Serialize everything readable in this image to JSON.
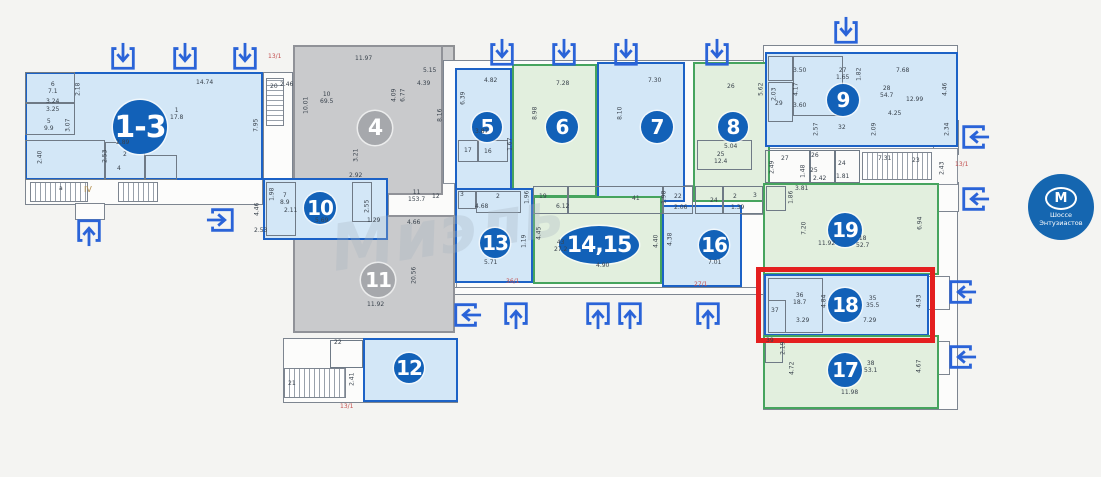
{
  "colors": {
    "blue_border": "#1c62c6",
    "blue_fill": "#d3e7f7",
    "green_border": "#46a45e",
    "green_fill": "#e2efde",
    "gray_fill": "#c9cacc",
    "badge_blue": "#1261b8",
    "badge_gray": "#a6a8ac",
    "arrow": "#2a63d8",
    "highlight_red": "#e41f1f",
    "annotation_red": "#c34f4f",
    "metro_blue": "#1566b0"
  },
  "watermark": {
    "text": "Миэль"
  },
  "metro": {
    "symbol": "М",
    "name": "Шоссе\nЭнтузиастов"
  },
  "highlight": {
    "x": 756,
    "y": 267,
    "w": 179,
    "h": 76
  },
  "structures": [
    {
      "x": 25,
      "y": 72,
      "w": 238,
      "h": 133,
      "cls": "st-outline"
    },
    {
      "x": 75,
      "y": 203,
      "w": 30,
      "h": 17,
      "cls": "st-outline"
    },
    {
      "x": 263,
      "y": 72,
      "w": 30,
      "h": 108,
      "cls": "st-outline"
    },
    {
      "x": 293,
      "y": 45,
      "w": 162,
      "h": 288,
      "cls": "st-gray"
    },
    {
      "x": 443,
      "y": 60,
      "w": 327,
      "h": 235,
      "cls": "st-outline"
    },
    {
      "x": 763,
      "y": 45,
      "w": 195,
      "h": 365,
      "cls": "st-outline"
    },
    {
      "x": 283,
      "y": 338,
      "w": 175,
      "h": 65,
      "cls": "st-outline"
    },
    {
      "x": 933,
      "y": 120,
      "w": 26,
      "h": 35,
      "cls": "st-outline"
    },
    {
      "x": 933,
      "y": 182,
      "w": 26,
      "h": 30,
      "cls": "st-outline"
    },
    {
      "x": 928,
      "y": 276,
      "w": 22,
      "h": 34,
      "cls": "st-outline"
    },
    {
      "x": 928,
      "y": 341,
      "w": 22,
      "h": 34,
      "cls": "st-outline"
    },
    {
      "x": 443,
      "y": 185,
      "w": 320,
      "h": 30,
      "cls": "st-corridor"
    },
    {
      "x": 388,
      "y": 183,
      "w": 67,
      "h": 42,
      "cls": "st-corridor"
    },
    {
      "x": 443,
      "y": 215,
      "w": 14,
      "h": 80,
      "cls": "st-corridor"
    },
    {
      "x": 763,
      "y": 148,
      "w": 195,
      "h": 37,
      "cls": "st-corridor"
    }
  ],
  "stairs": [
    {
      "x": 30,
      "y": 182,
      "w": 58,
      "h": 20
    },
    {
      "x": 118,
      "y": 182,
      "w": 40,
      "h": 20
    },
    {
      "x": 266,
      "y": 78,
      "w": 18,
      "h": 48,
      "dir": "v"
    },
    {
      "x": 862,
      "y": 152,
      "w": 70,
      "h": 28
    },
    {
      "x": 284,
      "y": 368,
      "w": 62,
      "h": 30
    }
  ],
  "units": [
    {
      "label": "1-3",
      "type": "blue",
      "x": 25,
      "y": 72,
      "w": 238,
      "h": 108,
      "badge": {
        "cx": 140,
        "cy": 127,
        "r": 27,
        "fs": 30
      }
    },
    {
      "label": "4",
      "type": "gray",
      "x": 293,
      "y": 45,
      "w": 150,
      "h": 150,
      "badge": {
        "cx": 375,
        "cy": 128,
        "r": 17,
        "fs": 22
      }
    },
    {
      "label": "11",
      "type": "gray",
      "x": 293,
      "y": 215,
      "w": 162,
      "h": 118,
      "badge": {
        "cx": 378,
        "cy": 280,
        "r": 17,
        "fs": 20
      }
    },
    {
      "label": "5",
      "type": "blue",
      "x": 455,
      "y": 68,
      "w": 57,
      "h": 127,
      "badge": {
        "cx": 487,
        "cy": 127,
        "r": 15,
        "fs": 20
      }
    },
    {
      "label": "6",
      "type": "green",
      "x": 512,
      "y": 64,
      "w": 85,
      "h": 133,
      "badge": {
        "cx": 562,
        "cy": 127,
        "r": 16,
        "fs": 20
      }
    },
    {
      "label": "7",
      "type": "blue",
      "x": 597,
      "y": 62,
      "w": 88,
      "h": 140,
      "badge": {
        "cx": 657,
        "cy": 127,
        "r": 16,
        "fs": 20
      }
    },
    {
      "label": "8",
      "type": "green",
      "x": 693,
      "y": 62,
      "w": 77,
      "h": 140,
      "badge": {
        "cx": 733,
        "cy": 127,
        "r": 15,
        "fs": 20
      }
    },
    {
      "label": "9",
      "type": "blue",
      "x": 765,
      "y": 52,
      "w": 193,
      "h": 95,
      "badge": {
        "cx": 843,
        "cy": 100,
        "r": 16,
        "fs": 20
      }
    },
    {
      "label": "10",
      "type": "blue",
      "x": 263,
      "y": 178,
      "w": 125,
      "h": 62,
      "badge": {
        "cx": 320,
        "cy": 208,
        "r": 16,
        "fs": 20
      }
    },
    {
      "label": "12",
      "type": "blue",
      "x": 363,
      "y": 338,
      "w": 95,
      "h": 64,
      "badge": {
        "cx": 409,
        "cy": 368,
        "r": 15,
        "fs": 20
      }
    },
    {
      "label": "13",
      "type": "blue",
      "x": 455,
      "y": 188,
      "w": 78,
      "h": 95,
      "badge": {
        "cx": 495,
        "cy": 243,
        "r": 15,
        "fs": 20
      }
    },
    {
      "label": "14,15",
      "type": "green",
      "x": 533,
      "y": 196,
      "w": 129,
      "h": 88,
      "badge": {
        "cx": 599,
        "cy": 245,
        "rx": 40,
        "ry": 19,
        "fs": 22
      }
    },
    {
      "label": "16",
      "type": "blue",
      "x": 662,
      "y": 205,
      "w": 80,
      "h": 82,
      "badge": {
        "cx": 714,
        "cy": 245,
        "r": 15,
        "fs": 20
      }
    },
    {
      "label": "19",
      "type": "green",
      "x": 763,
      "y": 183,
      "w": 176,
      "h": 92,
      "badge": {
        "cx": 845,
        "cy": 230,
        "r": 17,
        "fs": 20
      }
    },
    {
      "label": "18",
      "type": "blue",
      "x": 764,
      "y": 274,
      "w": 165,
      "h": 62,
      "badge": {
        "cx": 845,
        "cy": 305,
        "r": 17,
        "fs": 20
      },
      "highlighted": true
    },
    {
      "label": "17",
      "type": "green",
      "x": 763,
      "y": 335,
      "w": 176,
      "h": 74,
      "badge": {
        "cx": 845,
        "cy": 370,
        "r": 17,
        "fs": 20
      }
    }
  ],
  "partitions": [
    {
      "x": 25,
      "y": 72,
      "w": 50,
      "h": 31
    },
    {
      "x": 25,
      "y": 103,
      "w": 50,
      "h": 32
    },
    {
      "x": 25,
      "y": 140,
      "w": 80,
      "h": 40
    },
    {
      "x": 105,
      "y": 142,
      "w": 40,
      "h": 38
    },
    {
      "x": 145,
      "y": 155,
      "w": 32,
      "h": 25
    },
    {
      "x": 458,
      "y": 140,
      "w": 20,
      "h": 22
    },
    {
      "x": 478,
      "y": 140,
      "w": 30,
      "h": 22
    },
    {
      "x": 266,
      "y": 182,
      "w": 30,
      "h": 54
    },
    {
      "x": 352,
      "y": 182,
      "w": 20,
      "h": 40
    },
    {
      "x": 458,
      "y": 191,
      "w": 18,
      "h": 18
    },
    {
      "x": 476,
      "y": 191,
      "w": 45,
      "h": 22
    },
    {
      "x": 533,
      "y": 186,
      "w": 35,
      "h": 28
    },
    {
      "x": 568,
      "y": 186,
      "w": 95,
      "h": 28
    },
    {
      "x": 663,
      "y": 186,
      "w": 30,
      "h": 28
    },
    {
      "x": 695,
      "y": 186,
      "w": 28,
      "h": 28
    },
    {
      "x": 723,
      "y": 186,
      "w": 40,
      "h": 28
    },
    {
      "x": 697,
      "y": 140,
      "w": 55,
      "h": 30
    },
    {
      "x": 768,
      "y": 56,
      "w": 25,
      "h": 25
    },
    {
      "x": 768,
      "y": 82,
      "w": 25,
      "h": 40
    },
    {
      "x": 793,
      "y": 56,
      "w": 50,
      "h": 60
    },
    {
      "x": 765,
      "y": 150,
      "w": 45,
      "h": 33
    },
    {
      "x": 810,
      "y": 150,
      "w": 25,
      "h": 33
    },
    {
      "x": 835,
      "y": 150,
      "w": 25,
      "h": 33
    },
    {
      "x": 766,
      "y": 186,
      "w": 20,
      "h": 25
    },
    {
      "x": 768,
      "y": 278,
      "w": 55,
      "h": 55
    },
    {
      "x": 768,
      "y": 300,
      "w": 18,
      "h": 33
    },
    {
      "x": 765,
      "y": 338,
      "w": 18,
      "h": 25
    },
    {
      "x": 330,
      "y": 340,
      "w": 33,
      "h": 28
    }
  ],
  "corridor_lines": [
    {
      "x": 455,
      "y": 287,
      "w": 302,
      "h": 8
    }
  ],
  "arrows": [
    {
      "d": "down",
      "x": 108,
      "y": 42
    },
    {
      "d": "down",
      "x": 170,
      "y": 42
    },
    {
      "d": "down",
      "x": 230,
      "y": 42
    },
    {
      "d": "down",
      "x": 487,
      "y": 38
    },
    {
      "d": "down",
      "x": 549,
      "y": 38
    },
    {
      "d": "down",
      "x": 611,
      "y": 38
    },
    {
      "d": "down",
      "x": 702,
      "y": 38
    },
    {
      "d": "down",
      "x": 831,
      "y": 16
    },
    {
      "d": "up",
      "x": 74,
      "y": 217
    },
    {
      "d": "right",
      "x": 206,
      "y": 205
    },
    {
      "d": "left",
      "x": 452,
      "y": 300
    },
    {
      "d": "up",
      "x": 501,
      "y": 300
    },
    {
      "d": "up",
      "x": 583,
      "y": 300
    },
    {
      "d": "up",
      "x": 615,
      "y": 300
    },
    {
      "d": "up",
      "x": 693,
      "y": 300
    },
    {
      "d": "left",
      "x": 960,
      "y": 122
    },
    {
      "d": "left",
      "x": 960,
      "y": 184
    },
    {
      "d": "left",
      "x": 947,
      "y": 277
    },
    {
      "d": "left",
      "x": 947,
      "y": 342
    }
  ],
  "labels": [
    {
      "t": "14.74",
      "x": 196,
      "y": 80
    },
    {
      "t": "6\n7.1",
      "x": 48,
      "y": 82
    },
    {
      "t": "2.18",
      "x": 72,
      "y": 86,
      "r": 1
    },
    {
      "t": "3.24",
      "x": 46,
      "y": 99
    },
    {
      "t": "3.25",
      "x": 46,
      "y": 107
    },
    {
      "t": "5\n9.9",
      "x": 44,
      "y": 119
    },
    {
      "t": "3.07",
      "x": 62,
      "y": 122,
      "r": 1
    },
    {
      "t": "1\n17.8",
      "x": 170,
      "y": 108
    },
    {
      "t": "7.95",
      "x": 250,
      "y": 122,
      "r": 1
    },
    {
      "t": "2.40",
      "x": 34,
      "y": 154,
      "r": 1
    },
    {
      "t": "2.89",
      "x": 116,
      "y": 140
    },
    {
      "t": "2.53",
      "x": 99,
      "y": 153,
      "r": 1
    },
    {
      "t": "2",
      "x": 123,
      "y": 152
    },
    {
      "t": "4",
      "x": 117,
      "y": 166
    },
    {
      "t": "a",
      "x": 59,
      "y": 186
    },
    {
      "t": "IV",
      "x": 84,
      "y": 187,
      "c": "tan"
    },
    {
      "t": "13/1",
      "x": 268,
      "y": 54,
      "c": "red"
    },
    {
      "t": "20",
      "x": 270,
      "y": 84
    },
    {
      "t": "2.46",
      "x": 280,
      "y": 82
    },
    {
      "t": "11.97",
      "x": 355,
      "y": 56
    },
    {
      "t": "10\n69.5",
      "x": 320,
      "y": 92
    },
    {
      "t": "10.01",
      "x": 298,
      "y": 102,
      "r": 1
    },
    {
      "t": "5.15",
      "x": 423,
      "y": 68
    },
    {
      "t": "4.39",
      "x": 417,
      "y": 81
    },
    {
      "t": "4.09",
      "x": 388,
      "y": 92,
      "r": 1
    },
    {
      "t": "6.77",
      "x": 397,
      "y": 92,
      "r": 1
    },
    {
      "t": "8.16",
      "x": 434,
      "y": 112,
      "r": 1
    },
    {
      "t": "3.21",
      "x": 350,
      "y": 152,
      "r": 1
    },
    {
      "t": "2.92",
      "x": 349,
      "y": 173
    },
    {
      "t": "20.56",
      "x": 406,
      "y": 272,
      "r": 1
    },
    {
      "t": "11.92",
      "x": 367,
      "y": 302
    },
    {
      "t": "22",
      "x": 334,
      "y": 340
    },
    {
      "t": "21",
      "x": 288,
      "y": 381
    },
    {
      "t": "2.41",
      "x": 346,
      "y": 376,
      "r": 1
    },
    {
      "t": "13/1",
      "x": 340,
      "y": 404,
      "c": "red"
    },
    {
      "t": "1.98",
      "x": 266,
      "y": 191,
      "r": 1
    },
    {
      "t": "7\n8.9",
      "x": 280,
      "y": 193
    },
    {
      "t": "2.11",
      "x": 284,
      "y": 208
    },
    {
      "t": "5.69",
      "x": 315,
      "y": 218
    },
    {
      "t": "2.55",
      "x": 361,
      "y": 203,
      "r": 1
    },
    {
      "t": "1.29",
      "x": 367,
      "y": 218
    },
    {
      "t": "4.46",
      "x": 251,
      "y": 206,
      "r": 1
    },
    {
      "t": "2.53",
      "x": 254,
      "y": 228
    },
    {
      "t": "11\n153.7",
      "x": 408,
      "y": 190
    },
    {
      "t": "12",
      "x": 432,
      "y": 194
    },
    {
      "t": "4.66",
      "x": 407,
      "y": 220
    },
    {
      "t": "6.39",
      "x": 457,
      "y": 95,
      "r": 1
    },
    {
      "t": "4.82",
      "x": 484,
      "y": 78
    },
    {
      "t": "3.87",
      "x": 475,
      "y": 129
    },
    {
      "t": "17",
      "x": 464,
      "y": 148
    },
    {
      "t": "16",
      "x": 484,
      "y": 149
    },
    {
      "t": "1.67",
      "x": 504,
      "y": 141,
      "r": 1
    },
    {
      "t": "7.28",
      "x": 556,
      "y": 81
    },
    {
      "t": "8.98",
      "x": 529,
      "y": 110,
      "r": 1
    },
    {
      "t": "7.30",
      "x": 648,
      "y": 78
    },
    {
      "t": "8.10",
      "x": 614,
      "y": 110,
      "r": 1
    },
    {
      "t": "26",
      "x": 727,
      "y": 84
    },
    {
      "t": "5.62",
      "x": 755,
      "y": 86,
      "r": 1
    },
    {
      "t": "5.04",
      "x": 724,
      "y": 144
    },
    {
      "t": "25\n12.4",
      "x": 714,
      "y": 152
    },
    {
      "t": "19",
      "x": 539,
      "y": 194
    },
    {
      "t": "41",
      "x": 632,
      "y": 196
    },
    {
      "t": "1.98",
      "x": 658,
      "y": 194,
      "r": 1
    },
    {
      "t": "22",
      "x": 674,
      "y": 194
    },
    {
      "t": "2.06",
      "x": 674,
      "y": 205
    },
    {
      "t": "24",
      "x": 710,
      "y": 198
    },
    {
      "t": "2",
      "x": 733,
      "y": 194
    },
    {
      "t": "1.39",
      "x": 731,
      "y": 205
    },
    {
      "t": "3",
      "x": 753,
      "y": 193
    },
    {
      "t": "3",
      "x": 460,
      "y": 192
    },
    {
      "t": "2",
      "x": 496,
      "y": 194
    },
    {
      "t": "4.68",
      "x": 475,
      "y": 204
    },
    {
      "t": "1.96",
      "x": 521,
      "y": 194,
      "r": 1
    },
    {
      "t": "1.19",
      "x": 518,
      "y": 238,
      "r": 1
    },
    {
      "t": "5.71",
      "x": 484,
      "y": 260
    },
    {
      "t": "6.12",
      "x": 556,
      "y": 204
    },
    {
      "t": "4.45",
      "x": 533,
      "y": 230,
      "r": 1
    },
    {
      "t": "43\n27.2",
      "x": 554,
      "y": 240
    },
    {
      "t": "4.40",
      "x": 650,
      "y": 238,
      "r": 1
    },
    {
      "t": "4.90",
      "x": 596,
      "y": 263
    },
    {
      "t": "4.38",
      "x": 664,
      "y": 236,
      "r": 1
    },
    {
      "t": "7.01",
      "x": 708,
      "y": 260
    },
    {
      "t": "3.50",
      "x": 793,
      "y": 68
    },
    {
      "t": "27\n1.65",
      "x": 836,
      "y": 68
    },
    {
      "t": "1.82",
      "x": 853,
      "y": 71,
      "r": 1
    },
    {
      "t": "7.68",
      "x": 896,
      "y": 68
    },
    {
      "t": "2.03",
      "x": 768,
      "y": 91,
      "r": 1
    },
    {
      "t": "4.17",
      "x": 790,
      "y": 86,
      "r": 1
    },
    {
      "t": "29",
      "x": 775,
      "y": 101
    },
    {
      "t": "3.60",
      "x": 793,
      "y": 103
    },
    {
      "t": "28\n54.7",
      "x": 880,
      "y": 86
    },
    {
      "t": "12.99",
      "x": 906,
      "y": 97
    },
    {
      "t": "4.46",
      "x": 939,
      "y": 86,
      "r": 1
    },
    {
      "t": "4.25",
      "x": 888,
      "y": 111
    },
    {
      "t": "2.57",
      "x": 810,
      "y": 126,
      "r": 1
    },
    {
      "t": "32",
      "x": 838,
      "y": 125
    },
    {
      "t": "2.09",
      "x": 868,
      "y": 126,
      "r": 1
    },
    {
      "t": "2.34",
      "x": 941,
      "y": 126,
      "r": 1
    },
    {
      "t": "2.49",
      "x": 766,
      "y": 164,
      "r": 1
    },
    {
      "t": "27",
      "x": 781,
      "y": 156
    },
    {
      "t": "26",
      "x": 811,
      "y": 153
    },
    {
      "t": "1.48",
      "x": 797,
      "y": 168,
      "r": 1
    },
    {
      "t": "25",
      "x": 810,
      "y": 168
    },
    {
      "t": "2.42",
      "x": 813,
      "y": 176
    },
    {
      "t": "24",
      "x": 838,
      "y": 161
    },
    {
      "t": "1.81",
      "x": 836,
      "y": 174
    },
    {
      "t": "7.31",
      "x": 878,
      "y": 156
    },
    {
      "t": "23",
      "x": 912,
      "y": 158
    },
    {
      "t": "2.43",
      "x": 936,
      "y": 165,
      "r": 1
    },
    {
      "t": "13/1",
      "x": 955,
      "y": 162,
      "c": "red"
    },
    {
      "t": "3.81",
      "x": 795,
      "y": 186
    },
    {
      "t": "1.86",
      "x": 785,
      "y": 194,
      "r": 1
    },
    {
      "t": "7.20",
      "x": 798,
      "y": 225,
      "r": 1
    },
    {
      "t": "18\n52.7",
      "x": 856,
      "y": 236
    },
    {
      "t": "11.92",
      "x": 818,
      "y": 241
    },
    {
      "t": "6.94",
      "x": 914,
      "y": 220,
      "r": 1
    },
    {
      "t": "36\n18.7",
      "x": 793,
      "y": 293
    },
    {
      "t": "4.84",
      "x": 818,
      "y": 298,
      "r": 1
    },
    {
      "t": "35\n35.5",
      "x": 866,
      "y": 296
    },
    {
      "t": "4.93",
      "x": 913,
      "y": 298,
      "r": 1
    },
    {
      "t": "37",
      "x": 771,
      "y": 308
    },
    {
      "t": "3.29",
      "x": 796,
      "y": 318
    },
    {
      "t": "7.29",
      "x": 863,
      "y": 318
    },
    {
      "t": "39",
      "x": 766,
      "y": 338
    },
    {
      "t": "2.19",
      "x": 777,
      "y": 345,
      "r": 1
    },
    {
      "t": "4.72",
      "x": 786,
      "y": 365,
      "r": 1
    },
    {
      "t": "38\n53.1",
      "x": 864,
      "y": 361
    },
    {
      "t": "4.67",
      "x": 913,
      "y": 363,
      "r": 1
    },
    {
      "t": "11.98",
      "x": 841,
      "y": 390
    },
    {
      "t": "36/1",
      "x": 506,
      "y": 279,
      "c": "red"
    },
    {
      "t": "27/1",
      "x": 694,
      "y": 282,
      "c": "red"
    }
  ]
}
